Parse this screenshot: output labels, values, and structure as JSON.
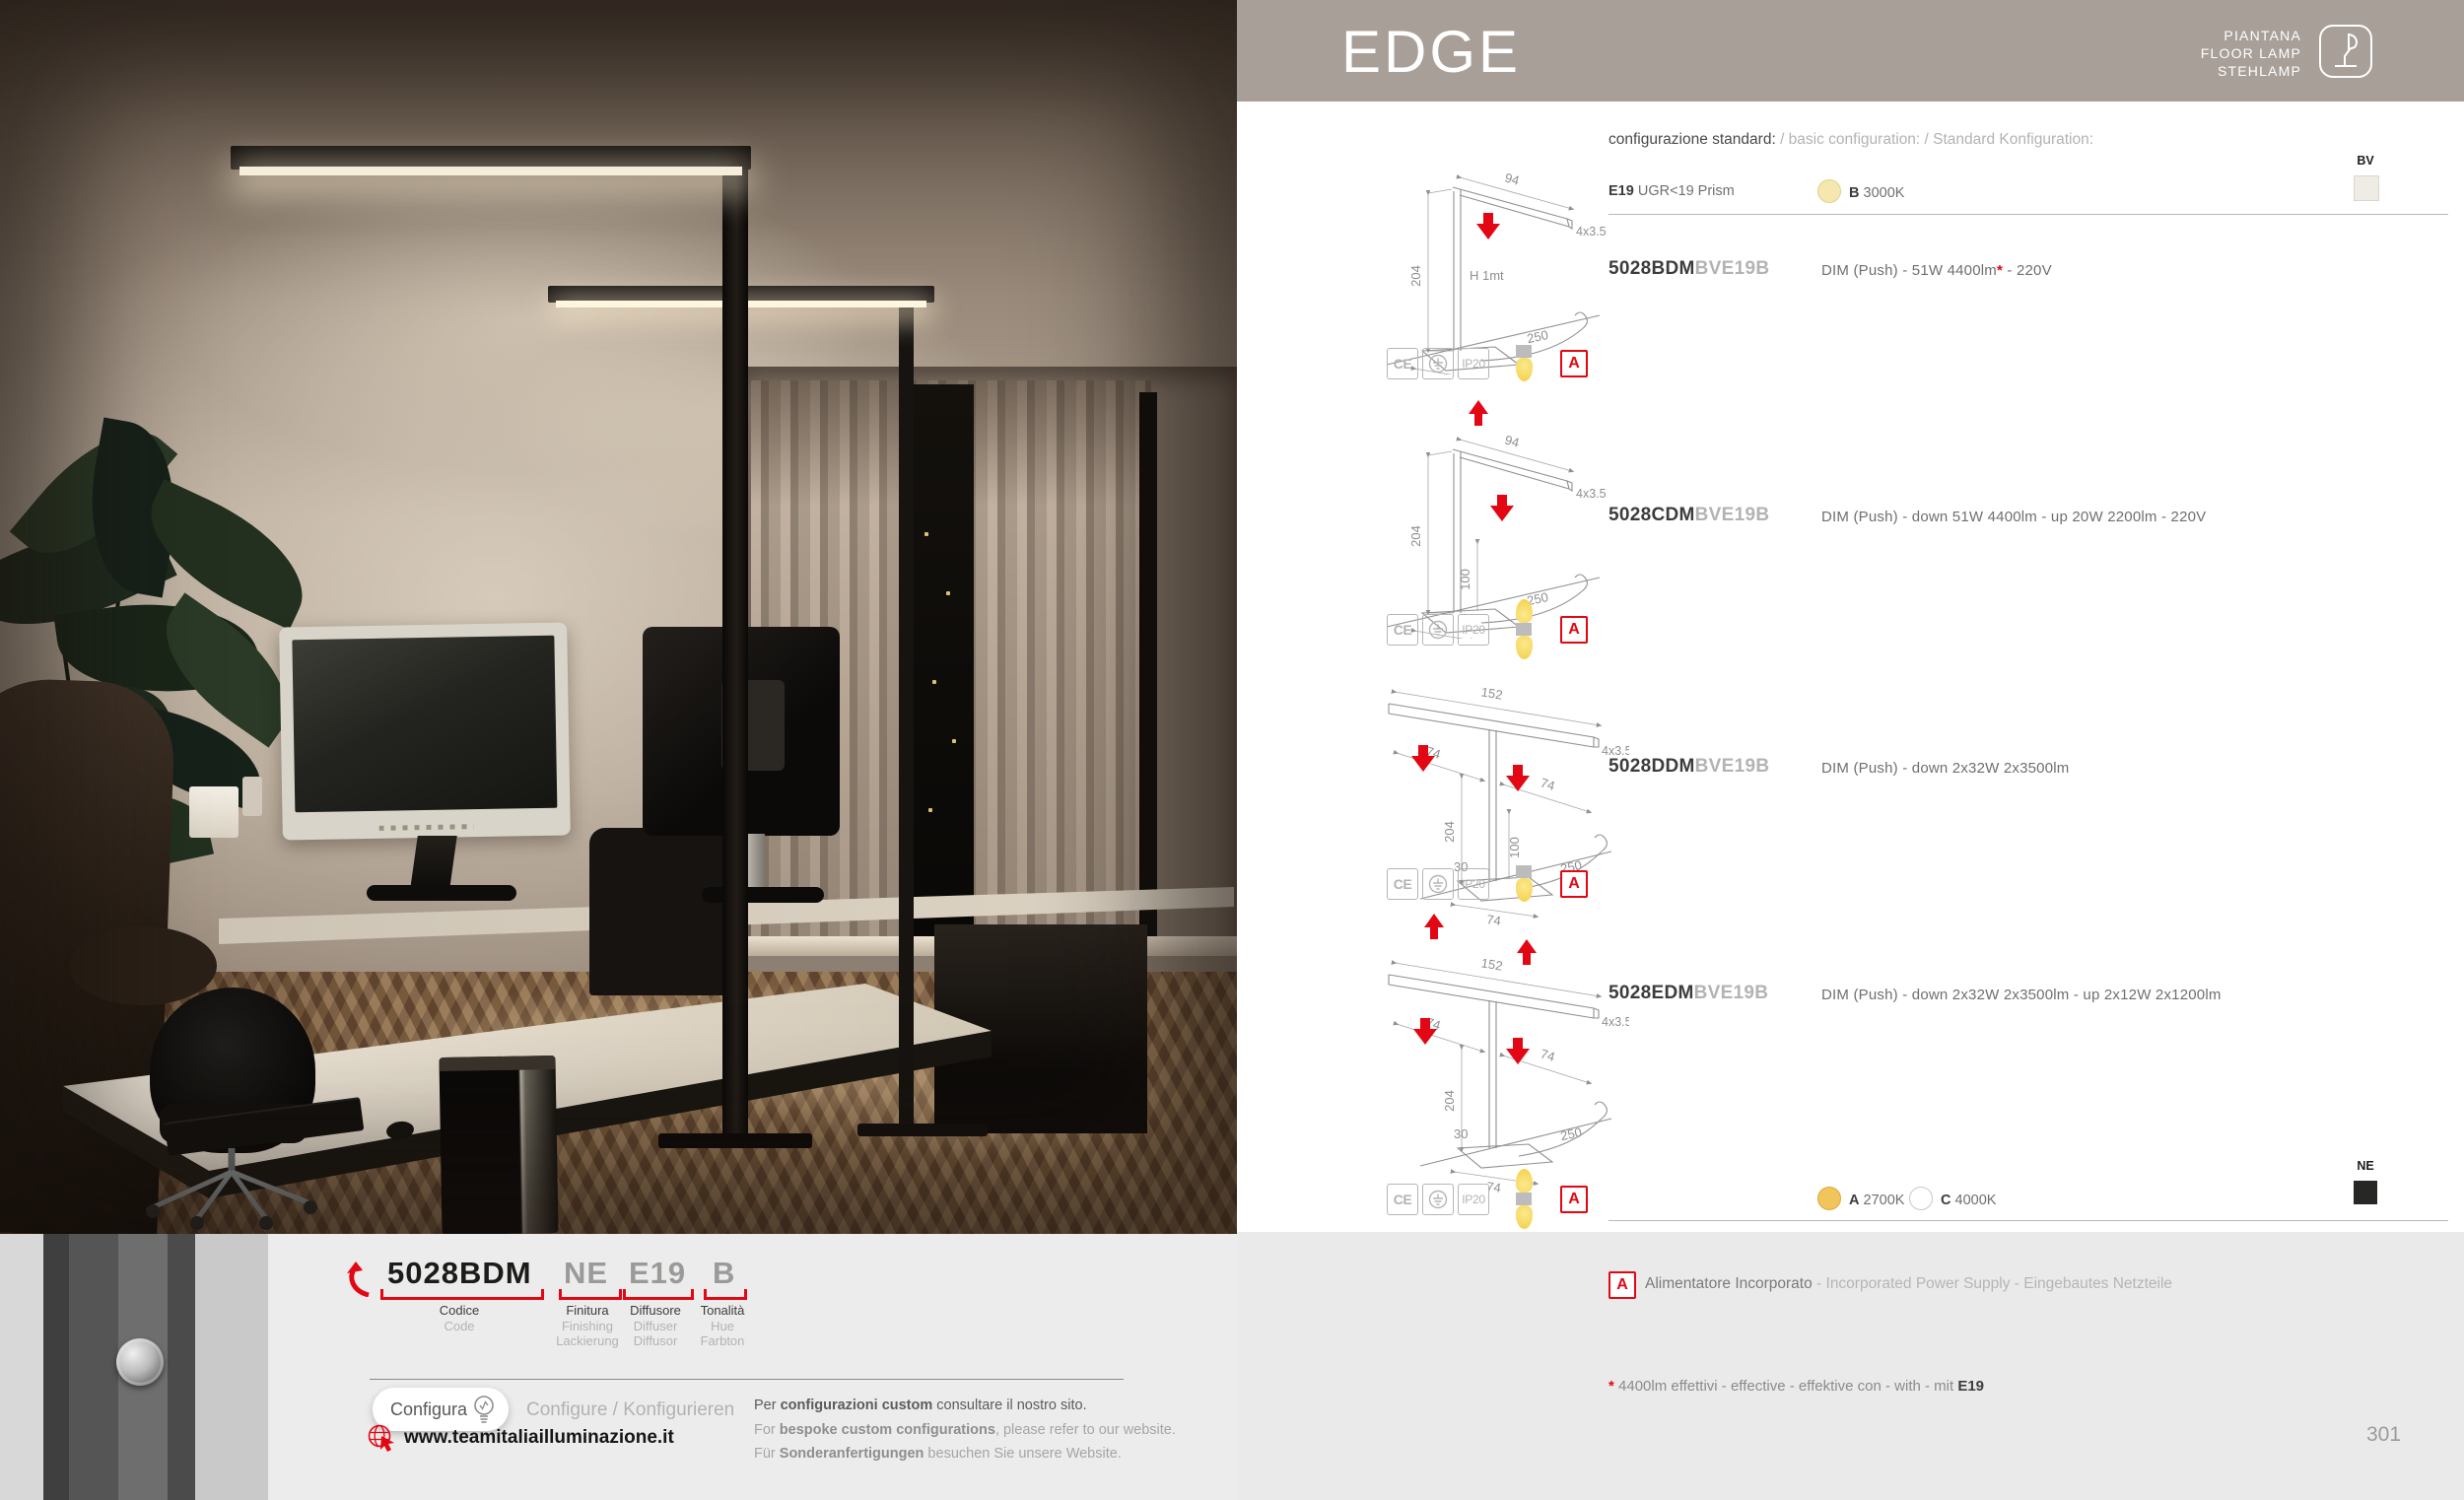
{
  "header": {
    "title": "EDGE",
    "category_lines": [
      "PIANTANA",
      "FLOOR LAMP",
      "STEHLAMP"
    ]
  },
  "config": {
    "title_primary": "configurazione standard:",
    "title_secondary": " / basic configuration: / Standard Konfiguration:",
    "diffuser_code": "E19",
    "diffuser_label": " UGR<19 Prism",
    "hue_b_code": "B",
    "hue_b_label": " 3000K",
    "hue_a_code": "A",
    "hue_a_label": " 2700K",
    "hue_c_code": "C",
    "hue_c_label": " 4000K",
    "finish_top_label": "BV",
    "finish_bottom_label": "NE"
  },
  "products": [
    {
      "code": "5028BDM",
      "suffix": "BVE19B",
      "desc_pre": "DIM (Push) - 51W 4400lm",
      "star": "*",
      "desc_post": " - 220V"
    },
    {
      "code": "5028CDM",
      "suffix": "BVE19B",
      "desc_pre": "DIM (Push) - down 51W 4400lm - up 20W 2200lm - 220V",
      "star": "",
      "desc_post": ""
    },
    {
      "code": "5028DDM",
      "suffix": "BVE19B",
      "desc_pre": "DIM (Push) - down 2x32W 2x3500lm",
      "star": "",
      "desc_post": ""
    },
    {
      "code": "5028EDM",
      "suffix": "BVE19B",
      "desc_pre": "DIM (Push) - down 2x32W 2x3500lm - up 2x12W 2x1200lm",
      "star": "",
      "desc_post": ""
    }
  ],
  "drawings": {
    "d1": {
      "width": "94",
      "section": "4x3.5",
      "height": "204",
      "note": "H 1mt",
      "cable": "250",
      "base": "55"
    },
    "d2": {
      "width": "94",
      "section": "4x3.5",
      "height": "204",
      "up": "100",
      "cable": "250",
      "base": "55"
    },
    "d3": {
      "width": "152",
      "section": "4x3.5",
      "left": "74",
      "right": "74",
      "height": "204",
      "up": "100",
      "offset": "30",
      "cable": "250",
      "base": "74"
    },
    "d4": {
      "width": "152",
      "section": "4x3.5",
      "left": "74",
      "right": "74",
      "height": "204",
      "offset": "30",
      "cable": "250",
      "base": "74"
    }
  },
  "certifications": {
    "ce": "CE",
    "ip20": "IP20",
    "power_badge": "A"
  },
  "icons": {
    "certs": [
      "ce-mark-icon",
      "earth-ground-icon",
      "ip20-rating-box"
    ],
    "bulb_down": "down-light-bulb-icon",
    "bulb_updown": "up-down-light-bulb-icon",
    "header_badge": "floor-lamp-icon",
    "configure": "lightbulb-icon",
    "website": "globe-cursor-icon",
    "code_pointer": "curved-arrow-icon"
  },
  "power_note": {
    "badge": "A",
    "primary": "Alimentatore Incorporato",
    "secondary": " - Incorporated Power Supply - Eingebautes Netzteile"
  },
  "footnote": {
    "star": "*",
    "text": " 4400lm effettivi - effective - effektive con - with - mit ",
    "bold": "E19"
  },
  "page_number": "301",
  "code_builder": {
    "code": "5028BDM",
    "finish": "NE",
    "diffuser": "E19",
    "hue": "B",
    "labels": {
      "code": [
        "Codice",
        "Code"
      ],
      "finish": [
        "Finitura",
        "Finishing",
        "Lackierung"
      ],
      "diffuser": [
        "Diffusore",
        "Diffuser",
        "Diffusor"
      ],
      "hue": [
        "Tonalità",
        "Hue",
        "Farbton"
      ]
    }
  },
  "configure": {
    "button": "Configura",
    "alt": "Configure / Konfigurieren",
    "website": "www.teamitaliailluminazione.it",
    "notes": [
      {
        "pre": "Per ",
        "bold": "configurazioni custom",
        "post": " consultare il nostro sito."
      },
      {
        "pre": "For ",
        "bold": "bespoke custom configurations",
        "post": ", please refer to our website."
      },
      {
        "pre": "Für ",
        "bold": "Sonderanfertigungen",
        "post": "  besuchen Sie unsere Website."
      }
    ]
  },
  "colors": {
    "accent_red": "#e30613",
    "band_taupe": "#a89f98",
    "bulb_yellow": "#f3cf44",
    "swatch_bv": "#efece5",
    "swatch_ne": "#272725",
    "hue_2700": "#f2c45c",
    "hue_3000": "#f5e7ae",
    "footer_gray": "#eaeaea"
  }
}
